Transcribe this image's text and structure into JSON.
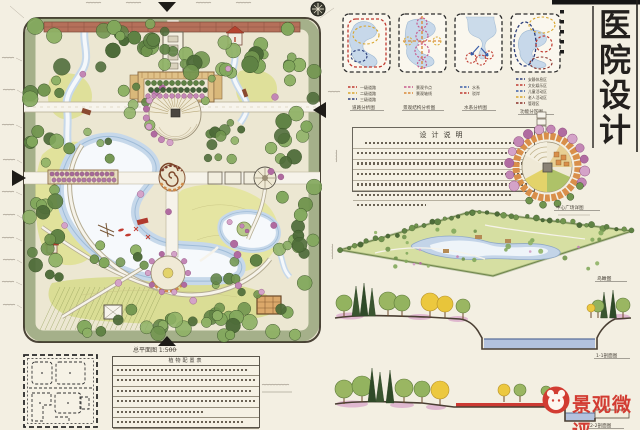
{
  "title_block": {
    "text": "医院设计",
    "chars": [
      "医",
      "院",
      "设",
      "计"
    ],
    "color": "#23201d"
  },
  "plan": {
    "label": "总平面图 1:500"
  },
  "analysis": {
    "items": [
      {
        "caption": "道路分析图",
        "legend": [
          {
            "color": "#c0392f",
            "label": "一级道路"
          },
          {
            "color": "#d9a62e",
            "label": "二级道路"
          },
          {
            "color": "#2c3e7a",
            "label": "三级道路"
          }
        ]
      },
      {
        "caption": "景观结构分析图",
        "legend": [
          {
            "color": "#c75b8d",
            "label": "景观节点"
          },
          {
            "color": "#d98a3a",
            "label": "景观轴线"
          }
        ]
      },
      {
        "caption": "水系分析图",
        "legend": [
          {
            "color": "#3a5ea8",
            "label": "水系"
          },
          {
            "color": "#c0392f",
            "label": "驳岸"
          }
        ]
      },
      {
        "caption": "功能分区图",
        "legend": [
          {
            "color": "#2c3e7a",
            "label": "安静休息区"
          },
          {
            "color": "#c0392f",
            "label": "文化娱乐区"
          },
          {
            "color": "#3a5ea8",
            "label": "儿童活动区"
          },
          {
            "color": "#d9a62e",
            "label": "老人活动区"
          },
          {
            "color": "#8a2f28",
            "label": "管理区"
          }
        ]
      }
    ]
  },
  "notes": {
    "title": "设计说明"
  },
  "detail": {
    "label": "中心广场详图"
  },
  "axon": {
    "label": "鸟瞰图"
  },
  "sections": {
    "s1_label": "1-1剖面图",
    "s2_label": "2-2剖面图"
  },
  "table": {
    "header": "植物配置表",
    "title": "苗木表"
  },
  "watermark": {
    "text": "景观微评",
    "color": "#d23c32"
  }
}
